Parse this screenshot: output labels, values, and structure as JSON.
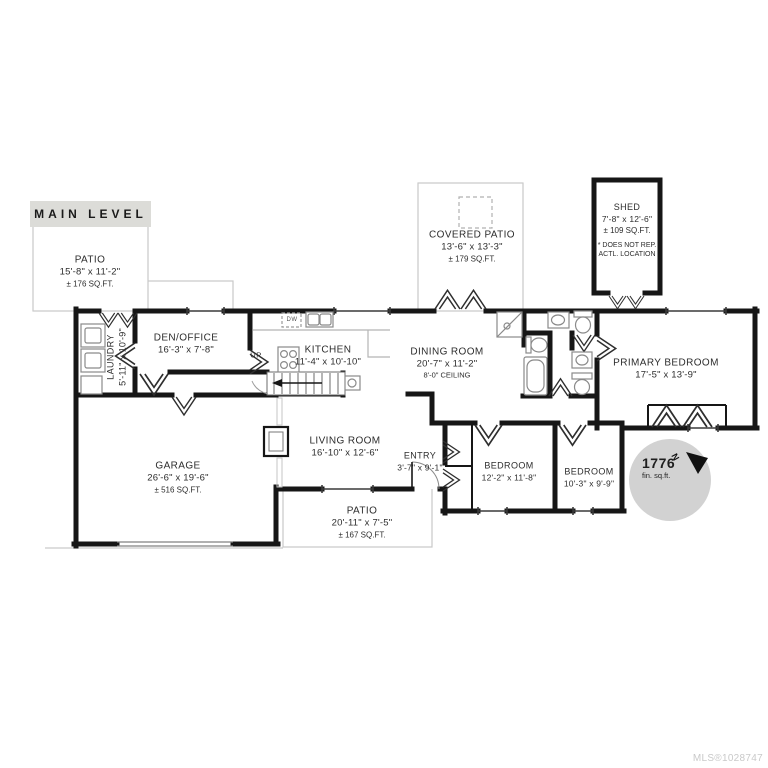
{
  "header": {
    "title": "MAIN LEVEL"
  },
  "watermark": {
    "mls": "MLS®1028747"
  },
  "total_area": {
    "value": "1776",
    "unit": "fin. sq.ft."
  },
  "compass": {
    "label": "N"
  },
  "stairs": {
    "label": "UP"
  },
  "appliances": {
    "dishwasher": "DW"
  },
  "colors": {
    "wall": "#161616",
    "light_outline": "#c9c9c9",
    "header_bar": "#dcdcd8",
    "badge_circle": "#d2d2d2",
    "text": "#2d2d2d"
  },
  "rooms": {
    "patio_upper": {
      "name": "PATIO",
      "dims": "15'-8\" x 11'-2\"",
      "area": "± 176 SQ.FT."
    },
    "covered_patio": {
      "name": "COVERED PATIO",
      "dims": "13'-6\" x 13'-3\"",
      "area": "± 179 SQ.FT."
    },
    "shed": {
      "name": "SHED",
      "dims": "7'-8\" x 12'-6\"",
      "area": "± 109 SQ.FT.",
      "note1": "* DOES NOT REP.",
      "note2": "ACTL. LOCATION"
    },
    "laundry": {
      "name": "LAUNDRY",
      "dims": "5'-11\" x 10'-9\""
    },
    "den_office": {
      "name": "DEN/OFFICE",
      "dims": "16'-3\" x 7'-8\""
    },
    "kitchen": {
      "name": "KITCHEN",
      "dims": "11'-4\" x 10'-10\""
    },
    "dining": {
      "name": "DINING ROOM",
      "dims": "20'-7\" x 11'-2\"",
      "ceiling": "8'-0\" CEILING"
    },
    "primary": {
      "name": "PRIMARY BEDROOM",
      "dims": "17'-5\" x 13'-9\""
    },
    "garage": {
      "name": "GARAGE",
      "dims": "26'-6\" x 19'-6\"",
      "area": "± 516 SQ.FT."
    },
    "living": {
      "name": "LIVING ROOM",
      "dims": "16'-10\" x 12'-6\""
    },
    "entry": {
      "name": "ENTRY",
      "dims": "3'-7\" x 9'-1\""
    },
    "bedroom1": {
      "name": "BEDROOM",
      "dims": "12'-2\" x 11'-8\""
    },
    "bedroom2": {
      "name": "BEDROOM",
      "dims": "10'-3\" x 9'-9\""
    },
    "patio_lower": {
      "name": "PATIO",
      "dims": "20'-11\" x 7'-5\"",
      "area": "± 167 SQ.FT."
    }
  }
}
